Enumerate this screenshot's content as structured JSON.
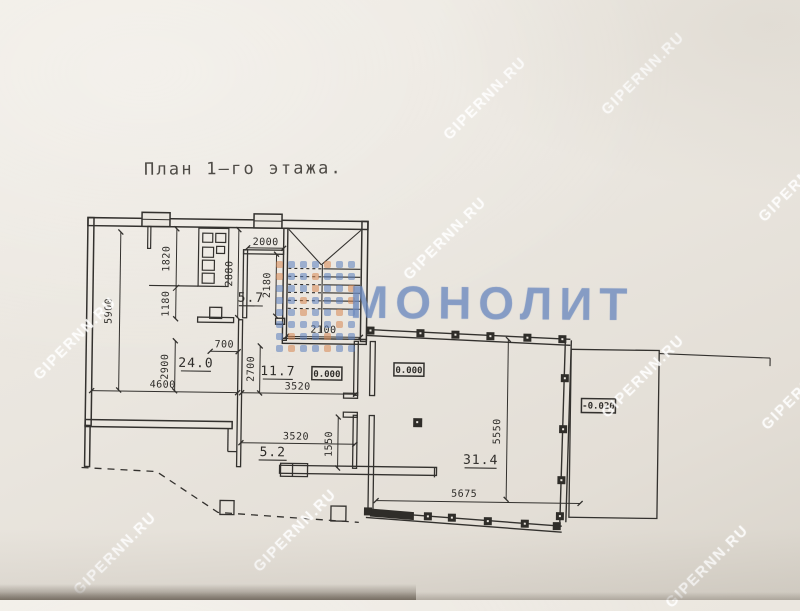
{
  "title": "План 1–го этажа.",
  "watermarks": {
    "site": "GIPERNN.RU",
    "brand": "МОНОЛИТ"
  },
  "colors": {
    "paper": "#eae6df",
    "ink": "#33312e",
    "brand_blue": "#6a88be",
    "logo_blue": "#5a7dbe",
    "logo_orange": "#d78752",
    "watermark_white": "#ffffff"
  },
  "rooms": {
    "r57": "5.7",
    "r240": "24.0",
    "r117": "11.7",
    "r52": "5.2",
    "r314": "31.4"
  },
  "elevations": {
    "hall_zero": "0.000",
    "main_zero": "0.000",
    "terrace": "-0.020"
  },
  "dims": {
    "d5900": "5900",
    "d1820": "1820",
    "d1180": "1180",
    "d2880": "2880",
    "d2000": "2000",
    "d2180": "2180",
    "d700": "700",
    "d2900": "2900",
    "d4600": "4600",
    "d2700": "2700",
    "d2100": "2100",
    "d3520a": "3520",
    "d3520b": "3520",
    "d1550": "1550",
    "d5550": "5550",
    "d5675": "5675"
  }
}
